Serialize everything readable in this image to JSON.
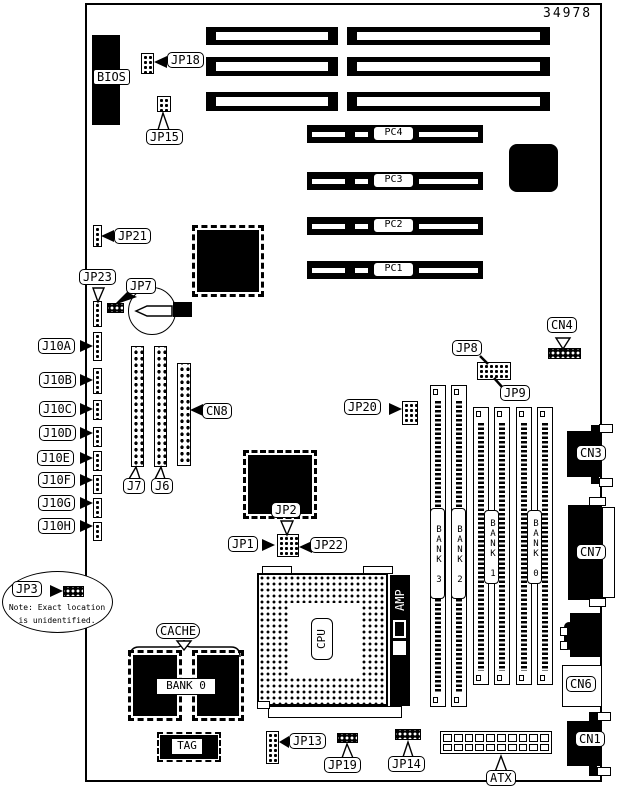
{
  "doc_number": "34978",
  "colors": {
    "ink": "#000000",
    "paper": "#ffffff"
  },
  "labels": {
    "bios": "BIOS",
    "jp18": "JP18",
    "jp15": "JP15",
    "jp21": "JP21",
    "jp23": "JP23",
    "jp7": "JP7",
    "cn8": "CN8",
    "jp8": "JP8",
    "jp9": "JP9",
    "cn4": "CN4",
    "jp20": "JP20",
    "jp2": "JP2",
    "jp1": "JP1",
    "jp22": "JP22",
    "jp3": "JP3",
    "jp13": "JP13",
    "jp19": "JP19",
    "jp14": "JP14",
    "atx": "ATX",
    "cn3": "CN3",
    "cn7": "CN7",
    "cn6": "CN6",
    "cn1": "CN1",
    "j7": "J7",
    "j6": "J6",
    "cache": "CACHE",
    "cache_bank": "BANK 0",
    "tag": "TAG",
    "cpu": "CPU",
    "amp": "AMP"
  },
  "pci_slots": [
    "PC4",
    "PC3",
    "PC2",
    "PC1"
  ],
  "j10_headers": [
    "J10A",
    "J10B",
    "J10C",
    "J10D",
    "J10E",
    "J10F",
    "J10G",
    "J10H"
  ],
  "memory_banks": [
    "BANK 3",
    "BANK 2",
    "BANK 1",
    "BANK 0"
  ],
  "note": {
    "line1": "Note: Exact location",
    "line2": "is unidentified."
  }
}
